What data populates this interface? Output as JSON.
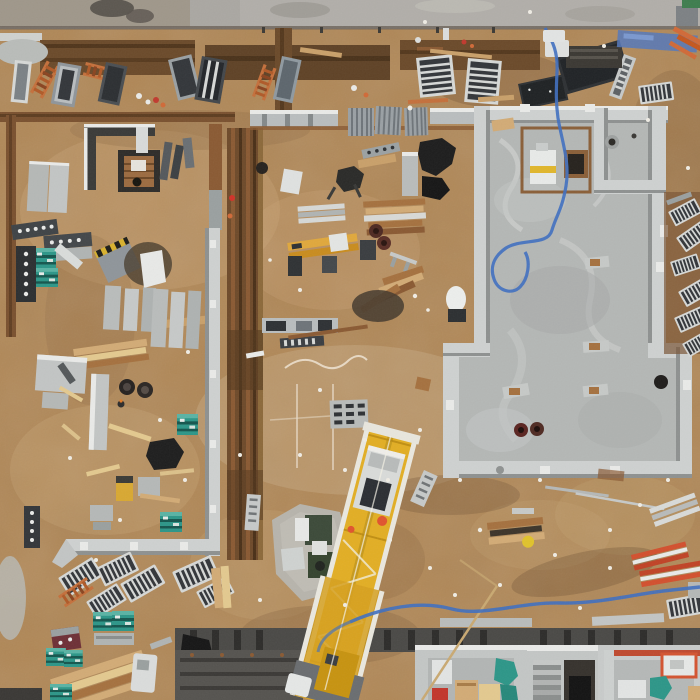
{
  "scene": {
    "type": "aerial-drone-photograph",
    "subject": "top-down view of a construction site: concrete foundation slab with formwork walls, mobile crane boom, excavation trenches, stacked formwork panels, ladders, lumber and material crates",
    "view": "orthogonal top-down",
    "lighting": "overcast daylight"
  },
  "palette": {
    "dirt_base": "#b08756",
    "dirt_light": "#cfae7e",
    "dirt_dark": "#7d5c38",
    "trench_rust": "#6b4a2a",
    "rust_line": "#8a5a33",
    "pavement": "#aaa7a2",
    "slab": "#b4b7b5",
    "wall_cap": "#ced1d0",
    "crane_yellow": "#e2ae24",
    "hose_blue": "#3f6fc0",
    "teal_crate": "#2d9688",
    "orange_ladder": "#c4703c",
    "pipe_red": "#cc4a2a",
    "tarp_black": "#1c1c1c",
    "wood_brown": "#a5713f",
    "wood_light": "#d2ab76",
    "panel_gray": "#9aa0a3",
    "formwork_dark": "#4a4946"
  },
  "objects": {
    "foundation_slab": "poured concrete slab with perimeter formwork walls and interior room",
    "crane": "yellow telescopic crane boom with trolley and carrier vehicle",
    "hose": "blue site water hose looping across slab and along lower yard",
    "materials": "formwork grid panels, orange ladders, teal equipment crates, lumber bundles, red drainage pipes",
    "building_bottom": "basement rooms under construction with stairwell",
    "trenches": "rust-brown excavation trenches along top edge and vertical center-left"
  }
}
